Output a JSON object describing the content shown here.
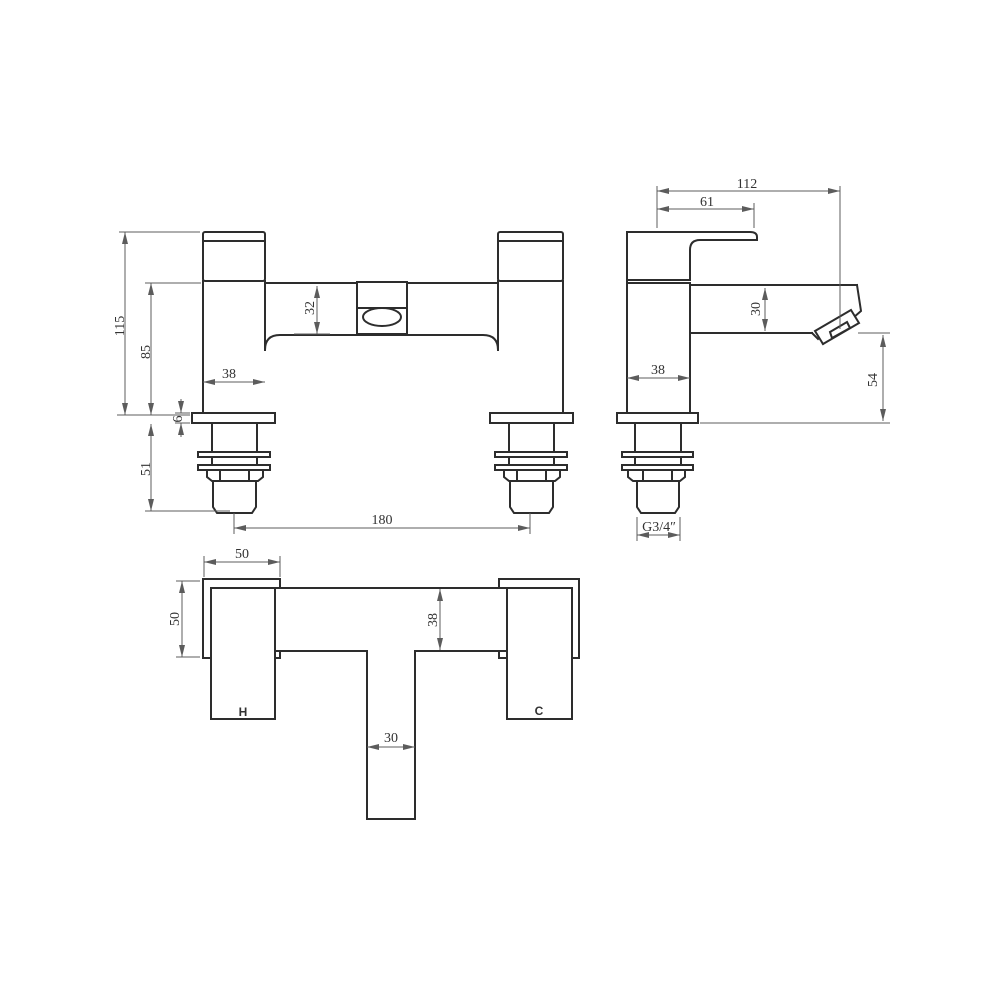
{
  "front_view": {
    "overall_height": "115",
    "body_height": "85",
    "bridge_height": "32",
    "pillar_width": "38",
    "plate_thickness": "6",
    "shank_length": "51",
    "tap_centres": "180"
  },
  "side_view": {
    "overall_depth": "112",
    "handle_reach": "61",
    "spout_depth": "30",
    "body_width": "38",
    "spout_clearance": "54",
    "thread_size": "G3/4″"
  },
  "plan_view": {
    "handle_width": "50",
    "handle_depth": "50",
    "body_depth": "38",
    "spout_width": "30",
    "hot_label": "H",
    "cold_label": "C"
  },
  "colors": {
    "background": "#ffffff",
    "outline": "#2d2d2d",
    "dimension": "#5c5c5c",
    "label": "#333333"
  }
}
